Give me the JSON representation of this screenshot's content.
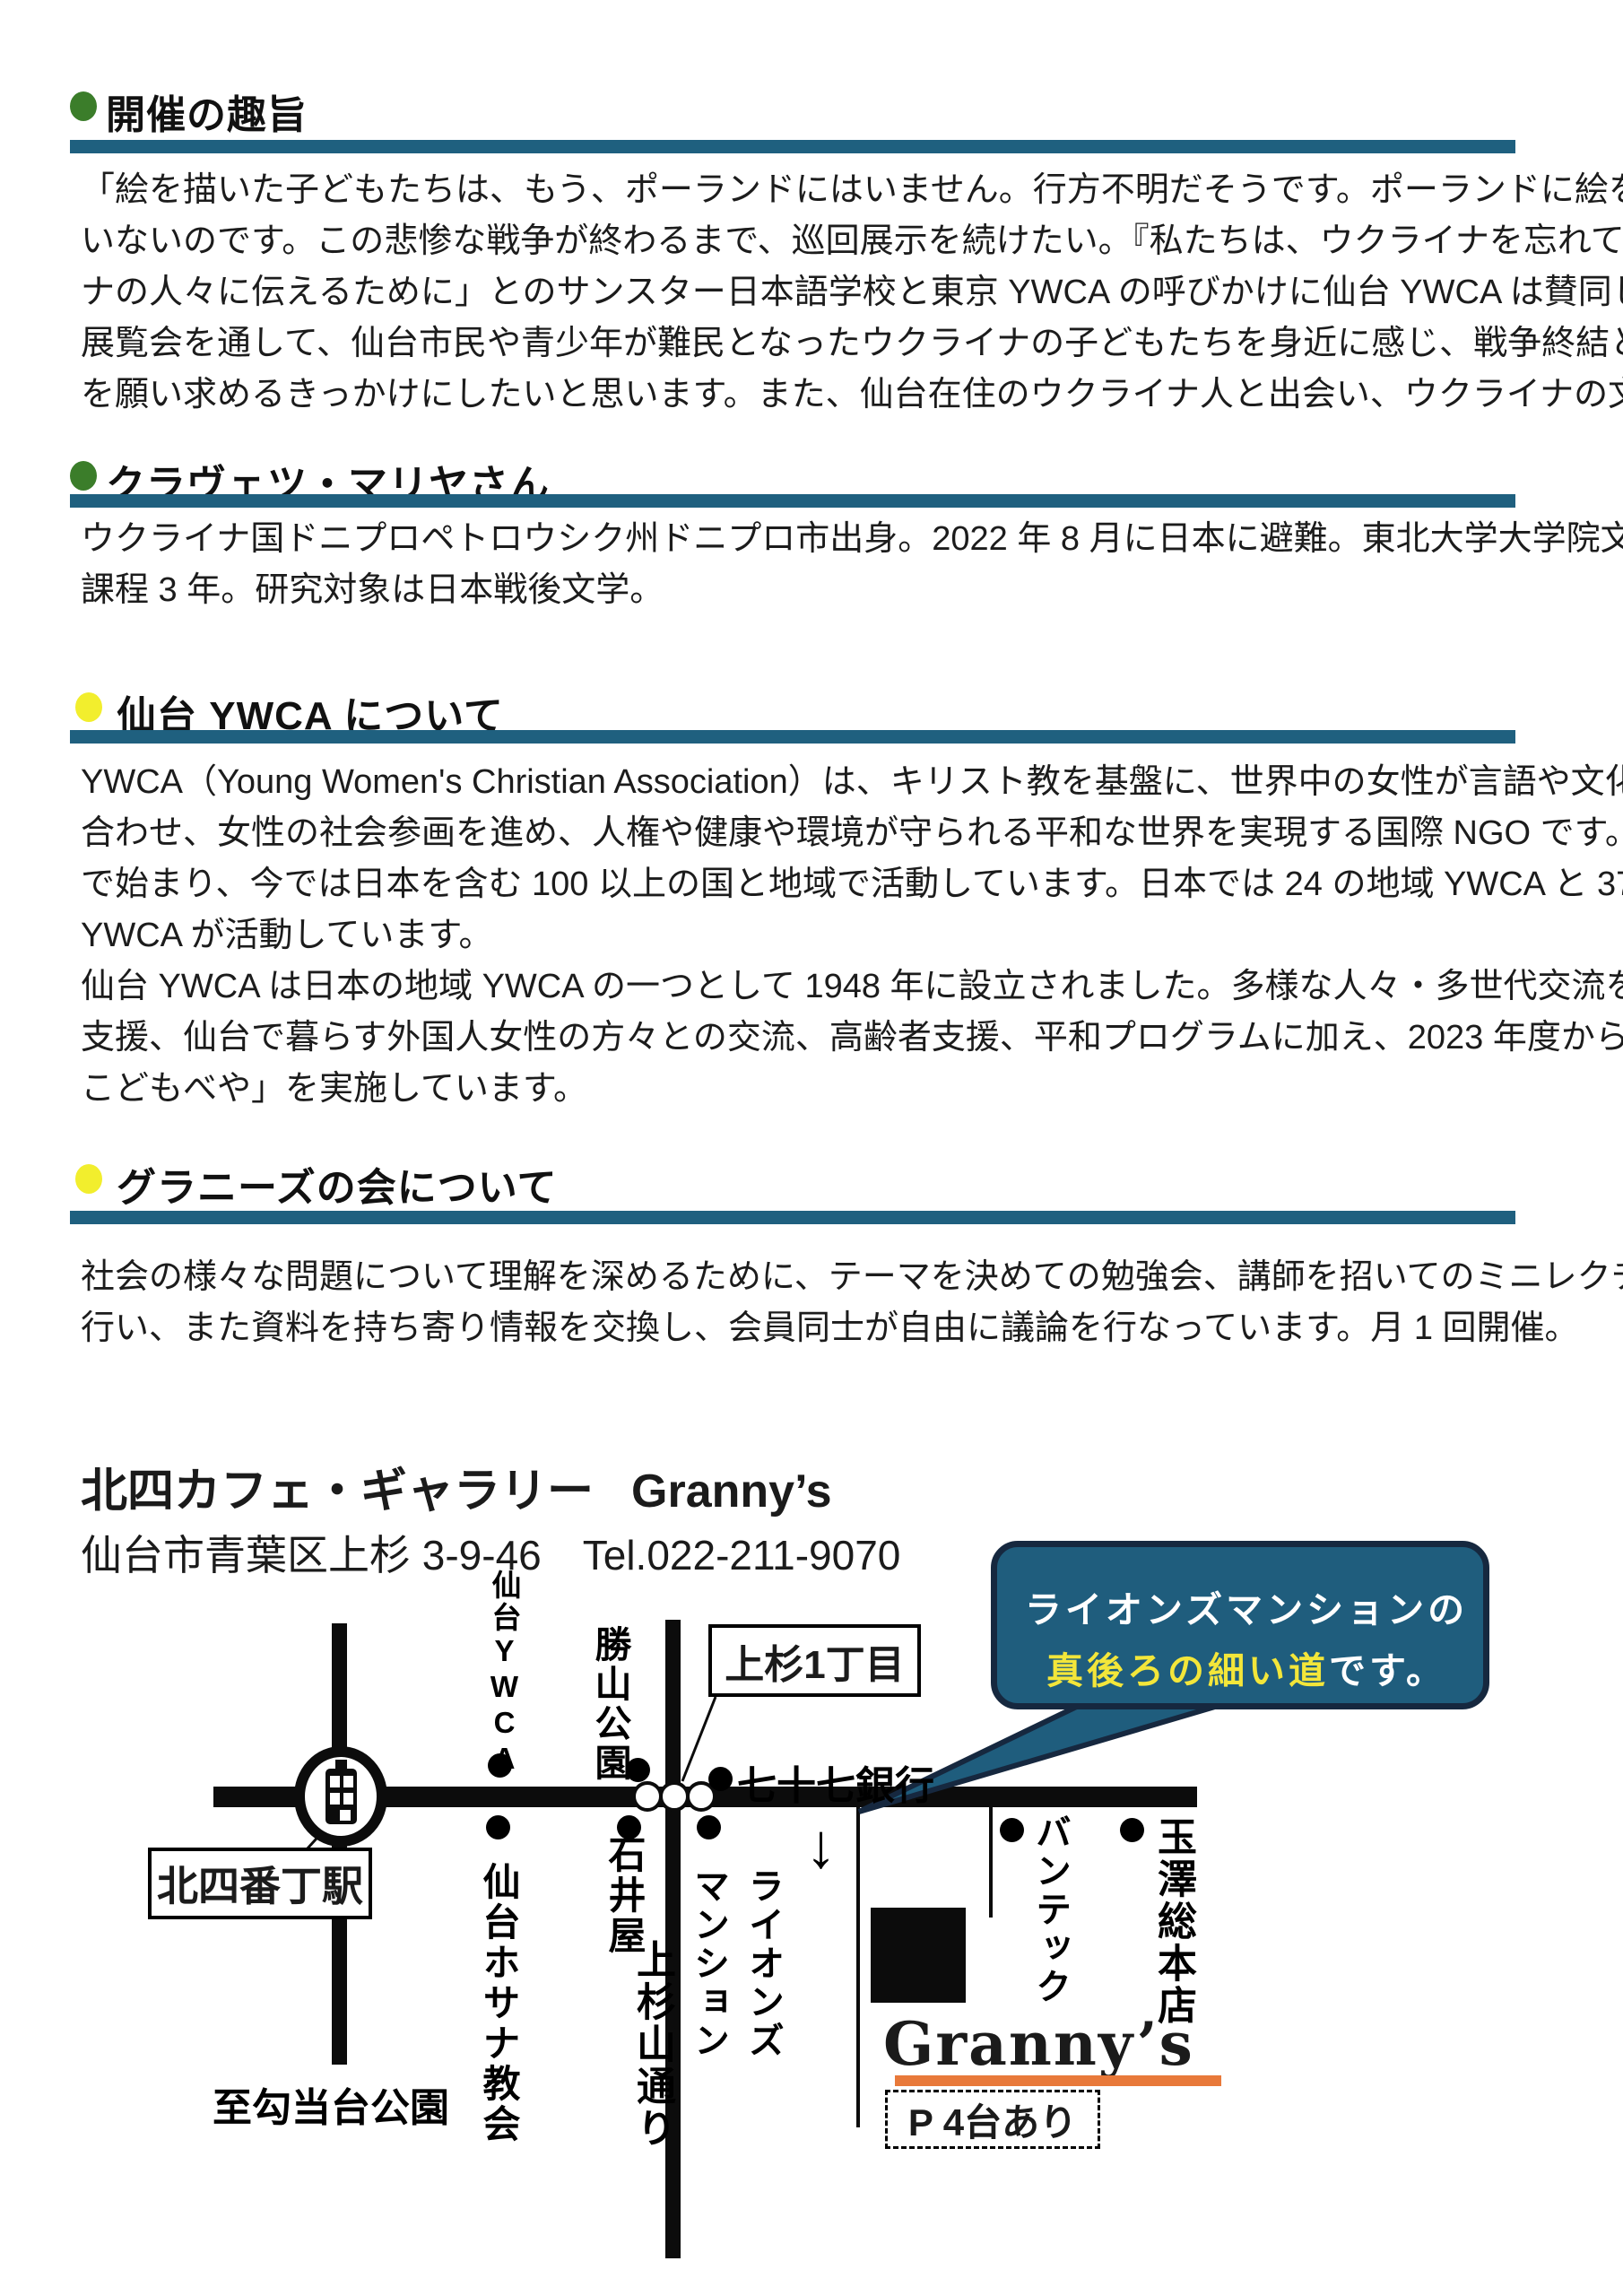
{
  "colors": {
    "bar_teal": "#1f607f",
    "bullet_green": "#3b7d2a",
    "bullet_yellow": "#f2ee2d",
    "bubble_fill": "#1f5d7d",
    "bubble_border": "#16283f",
    "bubble_highlight": "#f3e63a",
    "underline_orange": "#e8793a"
  },
  "sections": [
    {
      "title": "開催の趣旨",
      "bullet": "green",
      "lines": [
        "「絵を描いた子どもたちは、もう、ポーランドにはいません。行方不明だそうです。ポーランドに絵を返しても、受け取る子どもたちは",
        "いないのです。この悲惨な戦争が終わるまで、巡回展示を続けたい。『私たちは、ウクライナを忘れていません』という声をウクライ",
        "ナの人々に伝えるために」とのサンスター日本語学校と東京 YWCA の呼びかけに仙台 YWCA は賛同し、開催します。",
        "展覧会を通して、仙台市民や青少年が難民となったウクライナの子どもたちを身近に感じ、戦争終結と平穏な暮らしが戻ること",
        "を願い求めるきっかけにしたいと思います。また、仙台在住のウクライナ人と出会い、ウクライナの文化歴史を知る機会とします。"
      ]
    },
    {
      "title": "クラヴェツ・マリヤさん",
      "bullet": "green",
      "lines": [
        "ウクライナ国ドニプロペトロウシク州ドニプロ市出身。2022 年 8 月に日本に避難。東北大学大学院文学研究科の博士後期",
        "課程 3 年。研究対象は日本戦後文学。"
      ]
    },
    {
      "title": "仙台 YWCA について",
      "bullet": "yellow",
      "lines": [
        "YWCA（Young Women's Christian Association）は、キリスト教を基盤に、世界中の女性が言語や文化の壁を越えて力を",
        "合わせ、女性の社会参画を進め、人権や健康や環境が守られる平和な世界を実現する国際 NGO です。1855 年に英国",
        "で始まり、今では日本を含む 100 以上の国と地域で活動しています。日本では 24 の地域 YWCA と 37 の中学・高等学校",
        "YWCA が活動しています。",
        "仙台 YWCA は日本の地域 YWCA の一つとして 1948 年に設立されました。多様な人々・多世代交流をベースに、子育て",
        "支援、仙台で暮らす外国人女性の方々との交流、高齢者支援、平和プログラムに加え、2023 年度から学習支援「YWCA",
        "こどもべや」を実施しています。"
      ]
    },
    {
      "title": "グラニーズの会について",
      "bullet": "yellow",
      "lines": [
        "社会の様々な問題について理解を深めるために、テーマを決めての勉強会、講師を招いてのミニレクチャー、映像の視聴などを",
        "行い、また資料を持ち寄り情報を交換し、会員同士が自由に議論を行なっています。月 1 回開催。"
      ]
    }
  ],
  "venue": {
    "name_jp": "北四カフェ・ギャラリー",
    "name_en": "Granny’s",
    "address": "仙台市青葉区上杉 3-9-46　Tel.022-211-9070"
  },
  "map": {
    "bubble": {
      "line1": "ライオンズマンションの",
      "line2_highlight": "真後ろの細い道",
      "line2_rest": "です。"
    },
    "labels": {
      "sendai_ywca": "仙台YWCA",
      "katsuyama_park": "勝山公園",
      "kamisugi_1chome": "上杉1丁目",
      "bank_77": "七十七銀行",
      "kitayobancho_station": "北四番丁駅",
      "ishiiya": "石井屋",
      "hosanna_church": "仙台ホサナ教会",
      "lions_mansion_col1": "ライオンズ",
      "lions_mansion_col2": "マンション",
      "kamisugiyama_street": "上杉山通り",
      "to_kotodai_park": "至勾当台公園",
      "bantec": "バンテック",
      "tamazawa_honten": "玉澤総本店",
      "grannys": "Granny’s",
      "parking": "P 4台あり",
      "down_arrow": "↓"
    }
  }
}
